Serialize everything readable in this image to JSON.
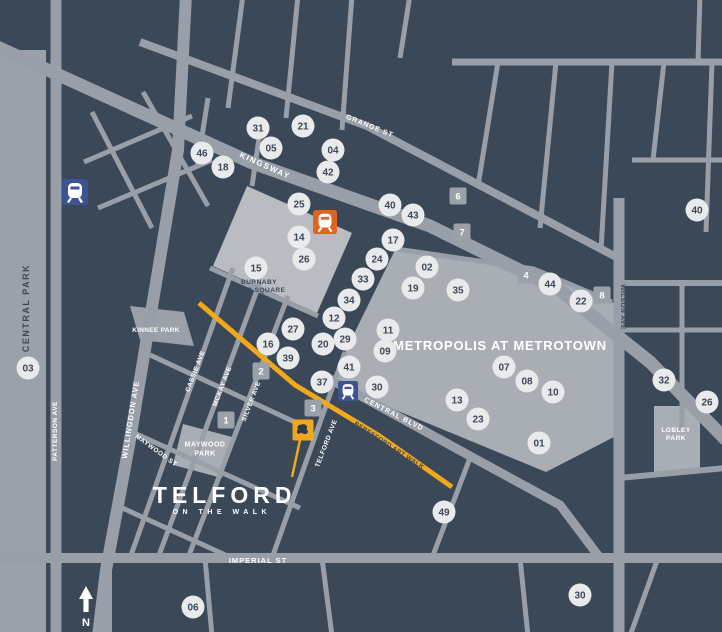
{
  "title": "Telford on the Walk area map - Metrotown",
  "colors": {
    "background": "#3b4858",
    "road": "#989fa8",
    "park": "#9aa1a9",
    "plaza": "#b9bdc2",
    "mall": "#a9aeb4",
    "circle_fill": "#e9eaeb",
    "navy": "#3b4858",
    "white": "#ffffff",
    "accent_yellow": "#f2a81d",
    "accent_orange": "#e0641f",
    "station_blue": "#3d5493"
  },
  "logo": {
    "title": "TELFORD",
    "subtitle": "ON THE WALK"
  },
  "compass": {
    "letter": "N"
  },
  "area_labels": [
    {
      "id": "central-park",
      "lines": [
        "CENTRAL PARK"
      ],
      "x": 29,
      "y": 308,
      "rot": -90,
      "fs": 9,
      "c": "navy",
      "ls": 1.5
    },
    {
      "id": "metropolis-at-metrotown",
      "lines": [
        "METROPOLIS AT METROTOWN"
      ],
      "x": 500,
      "y": 350,
      "rot": 0,
      "fs": 13,
      "c": "white",
      "ls": 0.8
    },
    {
      "id": "burnaby-civic-square",
      "lines": [
        "BURNABY",
        "CIVIC SQUARE"
      ],
      "x": 259,
      "y": 288,
      "rot": 0,
      "fs": 6.5,
      "c": "navy",
      "ls": 0.5,
      "lh": 8
    },
    {
      "id": "kinnee-park",
      "lines": [
        "KINNEE PARK"
      ],
      "x": 156,
      "y": 332,
      "rot": 0,
      "fs": 6.5,
      "c": "white",
      "ls": 0.3
    },
    {
      "id": "maywood-park",
      "lines": [
        "MAYWOOD",
        "PARK"
      ],
      "x": 205,
      "y": 451,
      "rot": 0,
      "fs": 7,
      "c": "white",
      "ls": 0.5,
      "lh": 9
    },
    {
      "id": "lobley-park",
      "lines": [
        "LOBLEY",
        "PARK"
      ],
      "x": 676,
      "y": 436,
      "rot": 0,
      "fs": 6.5,
      "c": "white",
      "ls": 0.5,
      "lh": 8
    }
  ],
  "street_labels": [
    {
      "id": "kingsway",
      "text": "KINGSWAY",
      "x": 264,
      "y": 168,
      "rot": 24,
      "fs": 8,
      "c": "white",
      "ls": 1.5
    },
    {
      "id": "grange-st",
      "text": "GRANGE ST",
      "x": 369,
      "y": 128,
      "rot": 22,
      "fs": 7,
      "c": "white",
      "ls": 1
    },
    {
      "id": "imperial-st",
      "text": "IMPERIAL ST",
      "x": 258,
      "y": 563,
      "rot": 0,
      "fs": 7.5,
      "c": "white",
      "ls": 1
    },
    {
      "id": "central-blvd",
      "text": "CENTRAL BLVD",
      "x": 393,
      "y": 416,
      "rot": 27,
      "fs": 7,
      "c": "white",
      "ls": 1
    },
    {
      "id": "beresford-art-walk",
      "text": "BERESFORD ART WALK",
      "x": 388,
      "y": 447,
      "rot": 33,
      "fs": 6.5,
      "c": "navy",
      "ls": 0.3
    },
    {
      "id": "willingdon-ave",
      "text": "WILLINGDON AVE",
      "x": 133,
      "y": 420,
      "rot": -81,
      "fs": 7.5,
      "c": "white",
      "ls": 1
    },
    {
      "id": "patterson-ave",
      "text": "PATTERSON AVE",
      "x": 57,
      "y": 431,
      "rot": -90,
      "fs": 6.5,
      "c": "white",
      "ls": 0.5
    },
    {
      "id": "wilson-ave",
      "text": "WILSON AVE",
      "x": 621,
      "y": 307,
      "rot": 90,
      "fs": 6.5,
      "c": "navy",
      "ls": 0.5
    },
    {
      "id": "cassie-ave",
      "text": "CASSIE AVE",
      "x": 197,
      "y": 372,
      "rot": -69,
      "fs": 6.5,
      "c": "white",
      "ls": 0.5
    },
    {
      "id": "mckay-ave",
      "text": "MCKAY AVE",
      "x": 224,
      "y": 387,
      "rot": -69,
      "fs": 6.5,
      "c": "white",
      "ls": 0.5
    },
    {
      "id": "silver-ave",
      "text": "SILVER AVE",
      "x": 253,
      "y": 402,
      "rot": -69,
      "fs": 6.5,
      "c": "white",
      "ls": 0.5
    },
    {
      "id": "telford-ave",
      "text": "TELFORD AVE",
      "x": 328,
      "y": 444,
      "rot": -69,
      "fs": 6.5,
      "c": "white",
      "ls": 0.5
    },
    {
      "id": "maywood-st",
      "text": "MAYWOOD ST",
      "x": 155,
      "y": 452,
      "rot": 36,
      "fs": 6.5,
      "c": "white",
      "ls": 0.5
    }
  ],
  "markers": {
    "circles": [
      {
        "n": "31",
        "x": 258,
        "y": 128
      },
      {
        "n": "21",
        "x": 303,
        "y": 126
      },
      {
        "n": "05",
        "x": 271,
        "y": 148
      },
      {
        "n": "46",
        "x": 202,
        "y": 153
      },
      {
        "n": "18",
        "x": 223,
        "y": 167
      },
      {
        "n": "04",
        "x": 333,
        "y": 150
      },
      {
        "n": "42",
        "x": 328,
        "y": 172
      },
      {
        "n": "25",
        "x": 299,
        "y": 204
      },
      {
        "n": "40",
        "x": 390,
        "y": 205
      },
      {
        "n": "43",
        "x": 413,
        "y": 215
      },
      {
        "n": "14",
        "x": 299,
        "y": 237
      },
      {
        "n": "17",
        "x": 393,
        "y": 240
      },
      {
        "n": "24",
        "x": 377,
        "y": 259
      },
      {
        "n": "26",
        "x": 304,
        "y": 259
      },
      {
        "n": "02",
        "x": 427,
        "y": 267
      },
      {
        "n": "15",
        "x": 256,
        "y": 268
      },
      {
        "n": "33",
        "x": 363,
        "y": 279
      },
      {
        "n": "19",
        "x": 413,
        "y": 288
      },
      {
        "n": "35",
        "x": 458,
        "y": 290
      },
      {
        "n": "34",
        "x": 349,
        "y": 300
      },
      {
        "n": "12",
        "x": 334,
        "y": 318
      },
      {
        "n": "27",
        "x": 293,
        "y": 329
      },
      {
        "n": "11",
        "x": 388,
        "y": 330
      },
      {
        "n": "29",
        "x": 345,
        "y": 339
      },
      {
        "n": "16",
        "x": 268,
        "y": 344
      },
      {
        "n": "20",
        "x": 323,
        "y": 344
      },
      {
        "n": "09",
        "x": 385,
        "y": 351
      },
      {
        "n": "39",
        "x": 288,
        "y": 358
      },
      {
        "n": "41",
        "x": 349,
        "y": 367
      },
      {
        "n": "07",
        "x": 504,
        "y": 367
      },
      {
        "n": "03",
        "x": 28,
        "y": 368
      },
      {
        "n": "32",
        "x": 664,
        "y": 380
      },
      {
        "n": "08",
        "x": 527,
        "y": 381
      },
      {
        "n": "37",
        "x": 322,
        "y": 382
      },
      {
        "n": "30",
        "x": 377,
        "y": 387
      },
      {
        "n": "10",
        "x": 553,
        "y": 392
      },
      {
        "n": "13",
        "x": 457,
        "y": 400
      },
      {
        "n": "26",
        "x": 707,
        "y": 402
      },
      {
        "n": "23",
        "x": 478,
        "y": 419
      },
      {
        "n": "01",
        "x": 539,
        "y": 443
      },
      {
        "n": "49",
        "x": 444,
        "y": 512
      },
      {
        "n": "44",
        "x": 550,
        "y": 284
      },
      {
        "n": "22",
        "x": 581,
        "y": 301
      },
      {
        "n": "40",
        "x": 697,
        "y": 210
      },
      {
        "n": "30",
        "x": 580,
        "y": 595
      },
      {
        "n": "06",
        "x": 193,
        "y": 607
      }
    ],
    "squares": [
      {
        "n": "1",
        "x": 226,
        "y": 420
      },
      {
        "n": "2",
        "x": 261,
        "y": 371
      },
      {
        "n": "3",
        "x": 313,
        "y": 408
      },
      {
        "n": "4",
        "x": 526,
        "y": 275
      },
      {
        "n": "6",
        "x": 458,
        "y": 196
      },
      {
        "n": "7",
        "x": 462,
        "y": 232
      },
      {
        "n": "8",
        "x": 602,
        "y": 295
      }
    ],
    "stations": [
      {
        "id": "skytrain-station-icon-patterson",
        "x": 75,
        "y": 192,
        "size": 26,
        "c": "station_blue"
      },
      {
        "id": "skytrain-station-icon-orange",
        "x": 325,
        "y": 222,
        "size": 24,
        "c": "accent_orange"
      },
      {
        "id": "skytrain-station-icon-metrotown",
        "x": 348,
        "y": 391,
        "size": 20,
        "c": "station_blue"
      }
    ],
    "site_pin": {
      "id": "telford-site-pin",
      "x": 303,
      "y": 430,
      "size": 21,
      "c": "accent_yellow"
    }
  }
}
